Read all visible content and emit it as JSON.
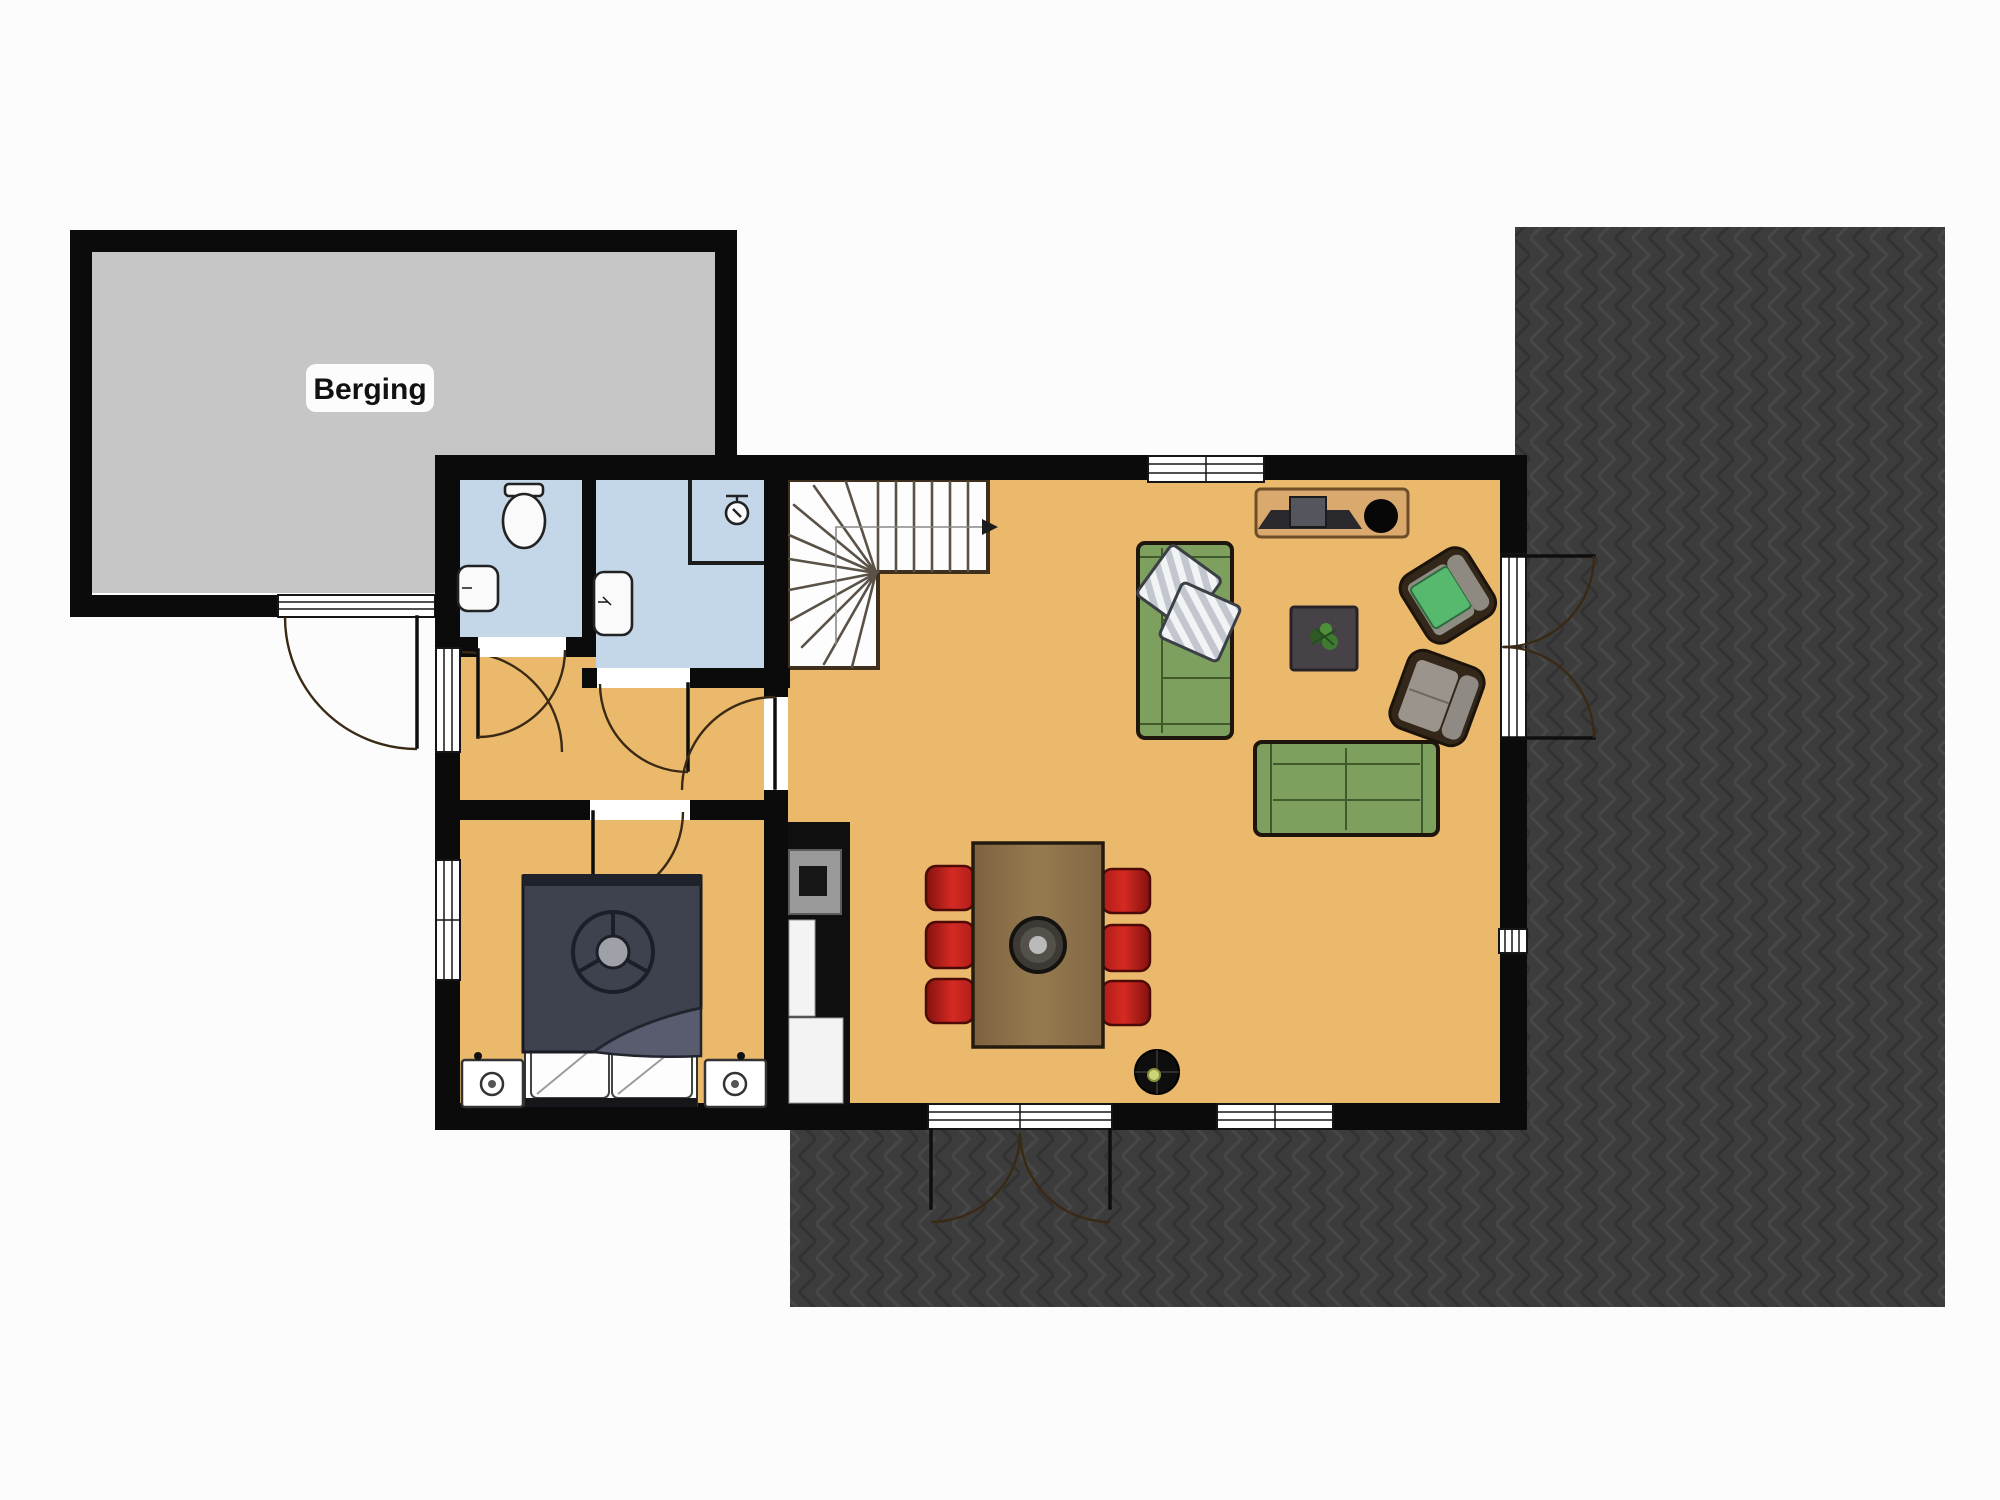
{
  "labels": {
    "storage_room": "Berging"
  },
  "colors": {
    "page_bg": "#fcfcfc",
    "wall": "#0b0b0b",
    "floor_main": "#ebb96c",
    "floor_wet": "#c4d7e9",
    "floor_storage": "#c6c6c6",
    "terrace_dark": "#3c3c3c",
    "stairs_bg": "#fdfdfd",
    "sofa_green": "#7da05e",
    "chair_red": "#c02420",
    "wood": "#8b6d48",
    "cabinet_tan": "#daa96e",
    "bed_dark": "#3e414e",
    "arc_brown": "#3a2a15",
    "accent_cushion_green": "#57b96d"
  },
  "rooms": {
    "storage": {
      "label": "Berging"
    }
  }
}
